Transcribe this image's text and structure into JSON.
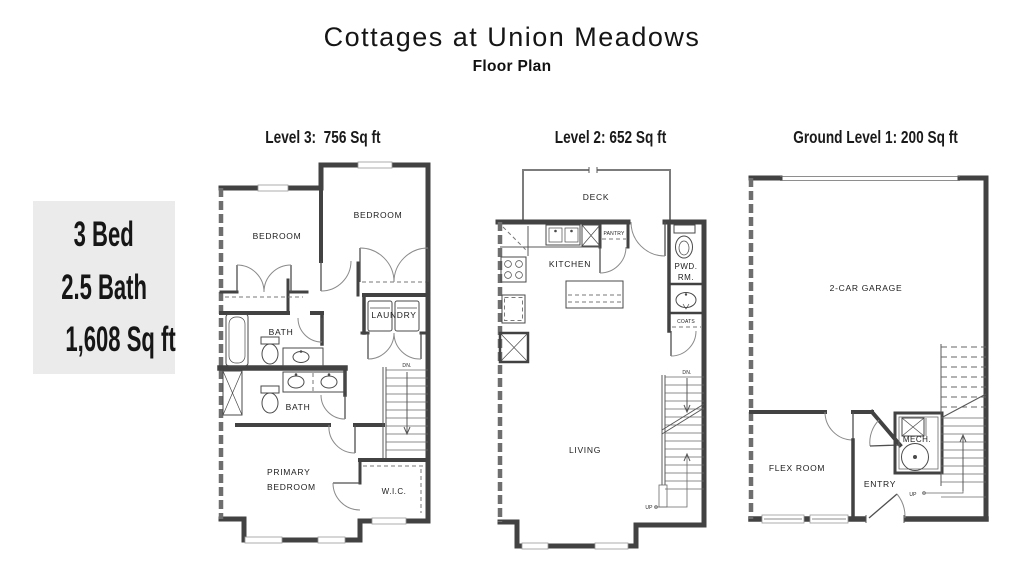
{
  "header": {
    "title": "Cottages at Union Meadows",
    "subtitle": "Floor Plan"
  },
  "summary": {
    "bed": "3 Bed",
    "bath": "2.5 Bath",
    "sqft": "1,608 Sq ft"
  },
  "levels": [
    {
      "label": "Level 3:  756 Sq ft",
      "rooms": {
        "bedroom_left": "BEDROOM",
        "bedroom_right": "BEDROOM",
        "bath_upper": "BATH",
        "laundry": "LAUNDRY",
        "bath_lower": "BATH",
        "primary_line1": "PRIMARY",
        "primary_line2": "BEDROOM",
        "wic": "W.I.C.",
        "dn": "DN."
      }
    },
    {
      "label": "Level 2: 652 Sq ft",
      "rooms": {
        "deck": "DECK",
        "kitchen": "KITCHEN",
        "pantry": "PANTRY",
        "pwd_line1": "PWD.",
        "pwd_line2": "RM.",
        "coats": "COATS",
        "living": "LIVING",
        "dn": "DN.",
        "up": "UP"
      }
    },
    {
      "label": "Ground Level 1: 200 Sq ft",
      "rooms": {
        "garage": "2-CAR GARAGE",
        "flex": "FLEX ROOM",
        "mech": "MECH.",
        "entry": "ENTRY",
        "up": "UP"
      }
    }
  ],
  "colors": {
    "background": "#ffffff",
    "summary_bg": "#ebebeb",
    "wall": "#424242",
    "party_wall": "#6e6e6e",
    "line": "#585858",
    "label_text": "#1d1d1d"
  }
}
